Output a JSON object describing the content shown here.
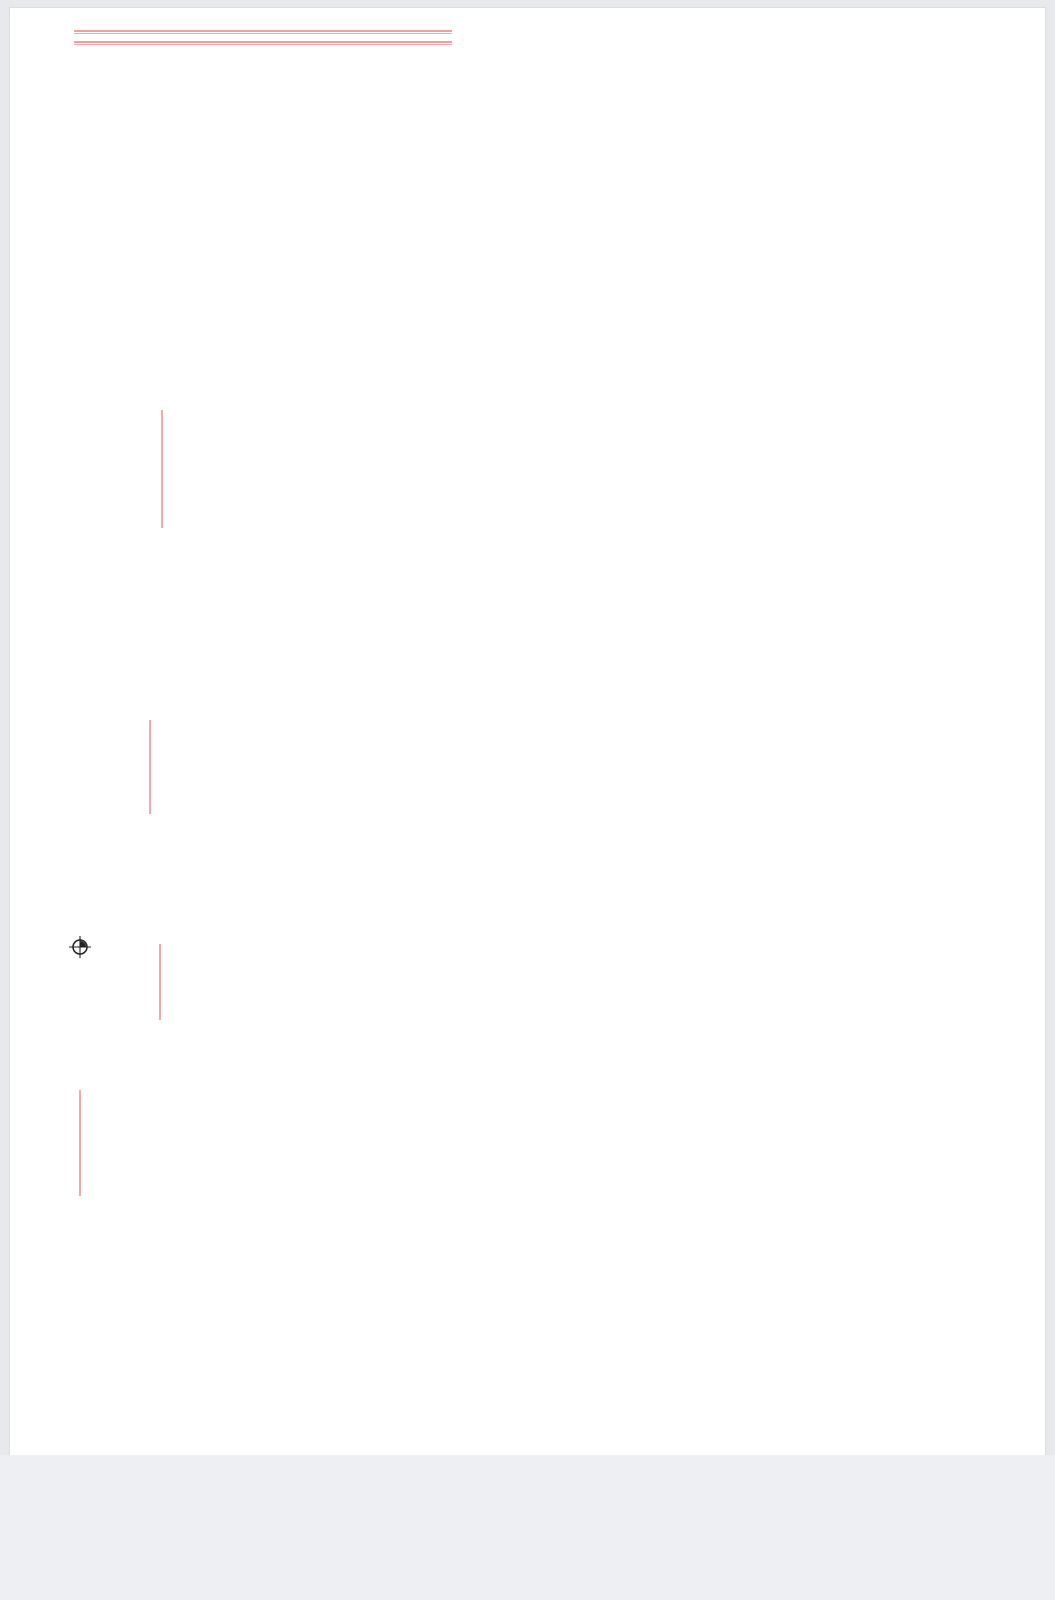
{
  "title_bar": {
    "title": "Capua 2 linee"
  },
  "annotations": {
    "top_line_1": "·· ···· ········· ·· ········· ·· ···· ·· · ·",
    "top_line_2": "· ···· ········· ··· ····· ········· ·· ······ ·· ··· ·",
    "left_vertical_1": "· ···· ········· ·· ·· · ·",
    "left_vertical_2": "· ···· ········· ·· ·· · ·",
    "left_vertical_3": "· ···· ········· ·· ·· · ·",
    "left_vertical_4": "······ ········ ··· ·· ·",
    "compass_label": "4T"
  },
  "legend_table": {
    "columns": 12,
    "bands": 3,
    "color": "#e04040"
  },
  "colors": {
    "border_blue": "#8282de",
    "track_dark": "#4a120e",
    "track_green": "#8ce08c",
    "track_blue": "#7b7be6",
    "track_magenta": "#ff72ff",
    "accent_red": "#e53434",
    "accent_cyan": "#38d6ea",
    "platform_green": "#52d24a",
    "benchwork_gray": "#9a9a9a",
    "hill_brown": "#9a4a42",
    "river_green": "#28b828"
  }
}
